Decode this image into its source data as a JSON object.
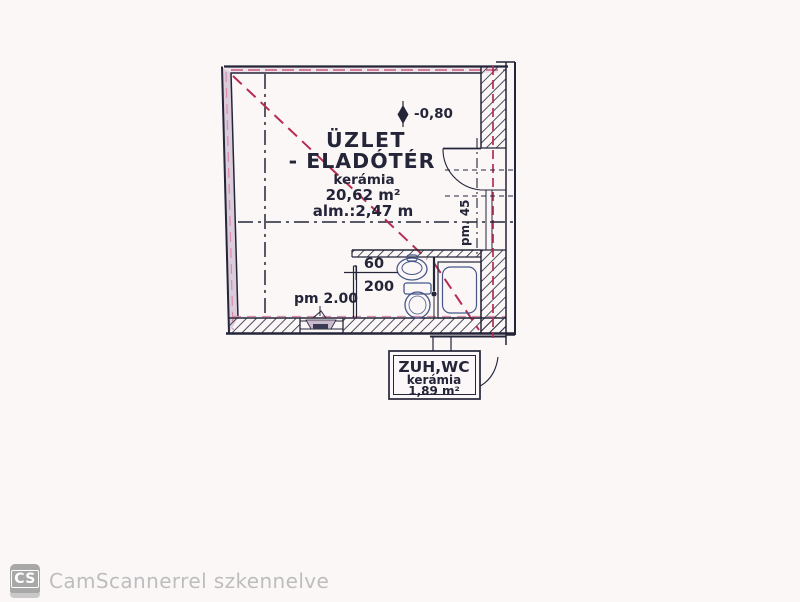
{
  "plan": {
    "main_room": {
      "title_line1": "ÜZLET",
      "title_line2": "- ELADÓTÉR",
      "material": "kerámia",
      "area": "20,62 m²",
      "height_note": "alm.:2,47 m"
    },
    "wet_room": {
      "title": "ZUH,WC",
      "material": "kerámia",
      "area": "1,89 m²"
    },
    "annotations": {
      "level_mark": "-0,80",
      "parapet_window_bottom": "pm 2.00",
      "parapet_window_right": "pm. 45",
      "door_width": "60",
      "door_height": "200"
    }
  },
  "watermark": {
    "logo": "CS",
    "text": "CamScannerrel szkennelve"
  },
  "colors": {
    "ink": "#242538",
    "marking_red": "#b62c52",
    "marking_pink": "#d98ca9",
    "fixture_blue": "#47578a",
    "watermark_gray": "#bdbdbd",
    "paper": "#fbf7f7"
  }
}
